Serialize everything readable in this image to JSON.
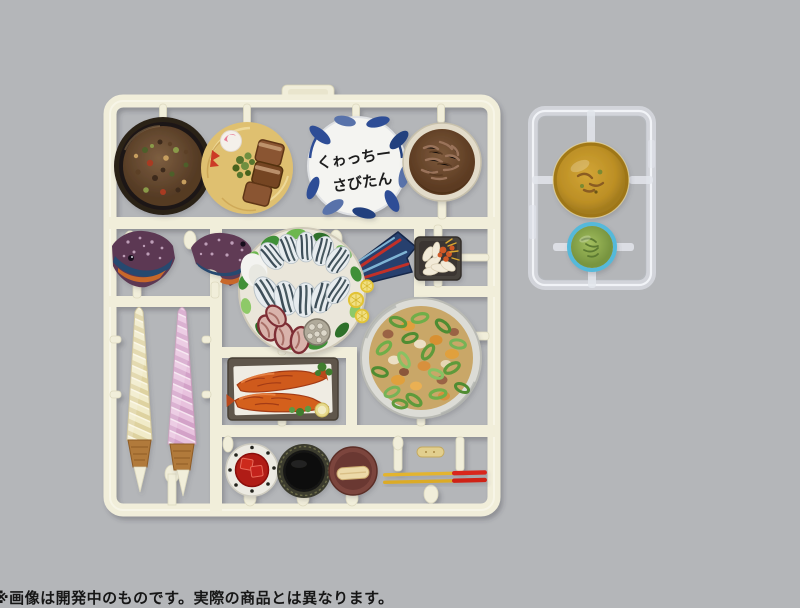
{
  "photo": {
    "background_color": "#b4b6b9",
    "disclaimer": "※画像は開発中のものです。実際の商品とは異なります。"
  },
  "main_runner": {
    "name": "okinawan-miniature-food-model-kit-runner",
    "plastic_color": "#f1eeda",
    "items": [
      "mixed-rice-bowl",
      "okinawa-soba-plate",
      "calligraphy-bowl",
      "stewed-meat-bowl",
      "fish-head-left-half",
      "fish-head-right-half",
      "parrotfish-sashimi-platter",
      "fish-tail-part",
      "island-scallion-dish",
      "vanilla-soft-serve-cone",
      "strawberry-soft-serve-cone",
      "fried-fish-tray",
      "goya-champuru-plate",
      "tofuyo-dish",
      "black-lacquer-cup",
      "dessert-dish",
      "small-stick-part",
      "red-tipped-chopsticks"
    ]
  },
  "calligraphy_bowl": {
    "line1": "くゎっちー",
    "line2": "さびたん",
    "ink_color": "#1d1d1f",
    "rim_color": "#2e4e96"
  },
  "clear_runner": {
    "name": "clear-runner-soup-parts",
    "plastic_color": "#e6e9ee",
    "items": [
      "amber-soup-disc",
      "seaweed-soup-disc"
    ],
    "soup_color": "#c3921f",
    "seaweed_color": "#8fae4e",
    "seaweed_rim_color": "#55b9da"
  },
  "chopsticks": {
    "body_color": "#e3b42f",
    "tip_color": "#d9261b"
  },
  "soft_serve": {
    "vanilla_color": "#f1ebc9",
    "strawberry_color": "#e8c2de",
    "cone_color": "#b17a3a"
  }
}
